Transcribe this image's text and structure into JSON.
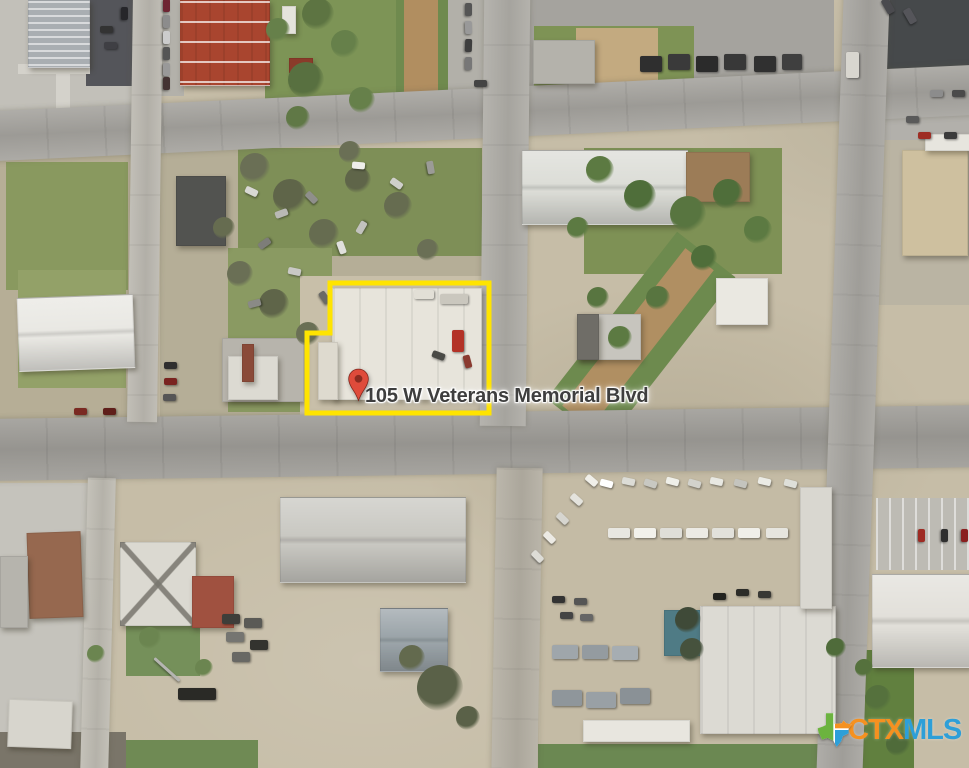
{
  "map": {
    "address_label": "105 W Veterans Memorial Blvd",
    "boundary_points": "330,283 489,283 489,413 307,413 307,333 330,333",
    "boundary_color": "#ffe400",
    "pin_color": "#df4b3b",
    "pin_hole_color": "#8c2b20",
    "label_color": "#3e3e3e"
  },
  "logo": {
    "ctx": "CTX",
    "mls": "MLS",
    "ctx_color": "#f59120",
    "mls_color": "#2d9fd8",
    "texas_green": "#6cb33f",
    "texas_orange": "#f59120",
    "texas_blue": "#2d9fd8"
  },
  "scene": {
    "ground": [
      [
        0,
        0,
        140,
        150,
        "#c2c0b9"
      ],
      [
        86,
        0,
        58,
        86,
        "#54555a"
      ],
      [
        18,
        64,
        72,
        10,
        "#d4d2cb"
      ],
      [
        56,
        64,
        14,
        50,
        "#d4d2cb"
      ],
      [
        144,
        0,
        40,
        96,
        "#b3b1aa"
      ],
      [
        265,
        0,
        132,
        124,
        "#7d9456"
      ],
      [
        396,
        0,
        52,
        122,
        "#6f8a4e"
      ],
      [
        404,
        0,
        34,
        118,
        "#b18e60"
      ],
      [
        448,
        0,
        82,
        98,
        "#b2b0a9"
      ],
      [
        528,
        0,
        306,
        96,
        "#a5a39e"
      ],
      [
        534,
        26,
        160,
        60,
        "#7e9355"
      ],
      [
        576,
        28,
        82,
        58,
        "#c3aa80"
      ],
      [
        884,
        0,
        85,
        80,
        "#46494b"
      ],
      [
        860,
        80,
        109,
        84,
        "#b2b0ab"
      ],
      [
        0,
        150,
        136,
        270,
        "#b6ae96"
      ],
      [
        6,
        162,
        122,
        128,
        "#89995f"
      ],
      [
        18,
        270,
        108,
        118,
        "#93a168"
      ],
      [
        160,
        148,
        322,
        270,
        "#b5ae97"
      ],
      [
        238,
        148,
        244,
        108,
        "#7e8f57"
      ],
      [
        228,
        248,
        104,
        164,
        "#8a9a62"
      ],
      [
        300,
        276,
        190,
        140,
        "#c8bfa9"
      ],
      [
        584,
        148,
        198,
        126,
        "#7e9155"
      ],
      [
        604,
        232,
        74,
        212,
        "#6d8a4e",
        38
      ],
      [
        620,
        238,
        36,
        200,
        "#b08f62",
        38
      ],
      [
        856,
        140,
        113,
        165,
        "#bab4a3"
      ],
      [
        540,
        462,
        286,
        316,
        "#c4bba5"
      ],
      [
        876,
        498,
        93,
        72,
        "#bdbbb4",
        0,
        "pstripes"
      ],
      [
        0,
        483,
        88,
        285,
        "#c5c3bc"
      ],
      [
        856,
        650,
        58,
        118,
        "#61803f"
      ],
      [
        126,
        614,
        74,
        62,
        "#75905a"
      ],
      [
        538,
        744,
        284,
        24,
        "#6b8852"
      ],
      [
        124,
        740,
        134,
        28,
        "#6f8a54"
      ],
      [
        0,
        732,
        126,
        36,
        "#7a7569"
      ]
    ],
    "roads": [
      [
        -12,
        88,
        994,
        50,
        "#a8a6a1",
        -2.7,
        "hroad"
      ],
      [
        -12,
        412,
        994,
        62,
        "#a19f9a",
        -0.8,
        "hroad"
      ],
      [
        482,
        -6,
        46,
        432,
        "#b0aea8",
        0.6,
        "vroad"
      ],
      [
        494,
        468,
        46,
        306,
        "#b6b1a5",
        1,
        "vroad"
      ],
      [
        830,
        -6,
        46,
        784,
        "#a9a7a2",
        2,
        "vroad"
      ],
      [
        130,
        -6,
        30,
        428,
        "#bdbab2",
        0.8,
        "vroad"
      ],
      [
        84,
        478,
        28,
        296,
        "#c0bdb4",
        1.5,
        "vroad"
      ]
    ],
    "buildings": [
      [
        28,
        0,
        60,
        66,
        "#a9aeb2",
        0,
        "stripesH"
      ],
      [
        180,
        0,
        88,
        84,
        "#a9452f",
        0,
        "redroof"
      ],
      [
        282,
        6,
        12,
        26,
        "#e5e3dc"
      ],
      [
        289,
        58,
        22,
        13,
        "#8a3b2a"
      ],
      [
        290,
        73,
        22,
        12,
        "#7e3626"
      ],
      [
        522,
        150,
        164,
        73,
        "#dcddd7",
        0,
        "ridgeH"
      ],
      [
        686,
        152,
        62,
        48,
        "#9c7c57"
      ],
      [
        716,
        278,
        50,
        45,
        "#eae8e1"
      ],
      [
        577,
        314,
        62,
        44,
        "#c7c5be"
      ],
      [
        577,
        314,
        20,
        44,
        "#6f6d67"
      ],
      [
        902,
        150,
        64,
        104,
        "#cec09f"
      ],
      [
        925,
        134,
        44,
        15,
        "#e7e5de"
      ],
      [
        176,
        176,
        48,
        68,
        "#525350"
      ],
      [
        18,
        296,
        114,
        72,
        "#e9e8e3",
        -2,
        "ridgeH"
      ],
      [
        222,
        338,
        80,
        62,
        "#b7b4ac"
      ],
      [
        228,
        356,
        48,
        42,
        "#dcdad2"
      ],
      [
        242,
        344,
        10,
        36,
        "#8a4a38"
      ],
      [
        332,
        288,
        148,
        110,
        "#e7e4db",
        0,
        "seams"
      ],
      [
        318,
        342,
        18,
        56,
        "#dedacf"
      ],
      [
        28,
        532,
        52,
        84,
        "#96684f",
        -2
      ],
      [
        120,
        542,
        74,
        82,
        "#dbd9d1",
        0,
        "xroof"
      ],
      [
        192,
        576,
        40,
        50,
        "#a05140"
      ],
      [
        280,
        497,
        184,
        84,
        "#c9c8c2",
        0,
        "ridgeH"
      ],
      [
        380,
        608,
        66,
        62,
        "#9ba4a9",
        0,
        "ridgeH"
      ],
      [
        664,
        610,
        40,
        44,
        "#4f7b85"
      ],
      [
        700,
        606,
        134,
        126,
        "#dcdad3",
        0,
        "seams"
      ],
      [
        800,
        487,
        30,
        120,
        "#d9d7d0"
      ],
      [
        872,
        574,
        96,
        92,
        "#e2e0da",
        0,
        "ridgeH"
      ],
      [
        8,
        700,
        62,
        46,
        "#d7d5cd",
        2
      ],
      [
        0,
        556,
        26,
        70,
        "#b6b4ad"
      ],
      [
        533,
        40,
        60,
        42,
        "#b4b2ab"
      ],
      [
        583,
        720,
        105,
        20,
        "#e8e6df"
      ]
    ],
    "trees": [
      [
        318,
        14,
        16,
        "#5d7442"
      ],
      [
        345,
        44,
        14,
        "#66804a"
      ],
      [
        306,
        80,
        18,
        "#587040"
      ],
      [
        362,
        100,
        13,
        "#66804a"
      ],
      [
        298,
        118,
        12,
        "#607846"
      ],
      [
        278,
        30,
        12,
        "#66804a"
      ],
      [
        255,
        168,
        15,
        "#6a6f55"
      ],
      [
        290,
        196,
        17,
        "#5f6549"
      ],
      [
        324,
        234,
        15,
        "#666c50"
      ],
      [
        240,
        274,
        13,
        "#6a6f55"
      ],
      [
        274,
        304,
        15,
        "#5f6549"
      ],
      [
        308,
        334,
        12,
        "#6a6f55"
      ],
      [
        358,
        180,
        13,
        "#5f6549"
      ],
      [
        398,
        206,
        14,
        "#666c50"
      ],
      [
        428,
        250,
        11,
        "#6a6f55"
      ],
      [
        224,
        228,
        11,
        "#666c50"
      ],
      [
        350,
        152,
        11,
        "#6a6f55"
      ],
      [
        600,
        170,
        14,
        "#5c7a42"
      ],
      [
        640,
        196,
        16,
        "#4f6e3a"
      ],
      [
        688,
        214,
        18,
        "#587540"
      ],
      [
        728,
        194,
        15,
        "#4f6e3a"
      ],
      [
        758,
        230,
        14,
        "#5c7a42"
      ],
      [
        704,
        258,
        13,
        "#4f6e3a"
      ],
      [
        658,
        298,
        12,
        "#587540"
      ],
      [
        620,
        338,
        12,
        "#5c7a42"
      ],
      [
        598,
        298,
        11,
        "#587540"
      ],
      [
        578,
        228,
        11,
        "#5c7a42"
      ],
      [
        440,
        688,
        23,
        "#5a6148"
      ],
      [
        412,
        658,
        13,
        "#636a4e"
      ],
      [
        468,
        718,
        12,
        "#5a6148"
      ],
      [
        96,
        654,
        9,
        "#6b8550"
      ],
      [
        150,
        638,
        11,
        "#6b8550"
      ],
      [
        204,
        668,
        9,
        "#6b8550"
      ],
      [
        878,
        698,
        13,
        "#55713d"
      ],
      [
        898,
        744,
        12,
        "#4f6b3a"
      ],
      [
        864,
        668,
        9,
        "#55713d"
      ],
      [
        688,
        620,
        13,
        "#3f4a38"
      ],
      [
        692,
        650,
        12,
        "#46523d"
      ],
      [
        836,
        648,
        10,
        "#4f6b3a"
      ]
    ],
    "vehicles": [
      [
        160,
        2,
        "#6e2533",
        90
      ],
      [
        160,
        18,
        "#8c8c8c",
        90
      ],
      [
        160,
        34,
        "#cccccc",
        90
      ],
      [
        160,
        50,
        "#555555",
        90
      ],
      [
        160,
        66,
        "#999999",
        90
      ],
      [
        160,
        80,
        "#443333",
        90
      ],
      [
        100,
        26,
        "#333333",
        0
      ],
      [
        118,
        10,
        "#26262a",
        90
      ],
      [
        104,
        42,
        "#3f3f44",
        0
      ],
      [
        462,
        6,
        "#555555",
        90
      ],
      [
        462,
        24,
        "#999999",
        88
      ],
      [
        462,
        42,
        "#3e3e3e",
        92
      ],
      [
        462,
        60,
        "#777777",
        90
      ],
      [
        474,
        80,
        "#444444",
        0
      ],
      [
        640,
        56,
        "#2f2f2f",
        0,
        22,
        16
      ],
      [
        668,
        54,
        "#3a3a3a",
        0,
        22,
        16
      ],
      [
        696,
        56,
        "#2b2b2b",
        0,
        22,
        16
      ],
      [
        724,
        54,
        "#383838",
        0,
        22,
        16
      ],
      [
        754,
        56,
        "#303030",
        0,
        22,
        16
      ],
      [
        782,
        54,
        "#3f3f3f",
        0,
        20,
        16
      ],
      [
        846,
        52,
        "#d8d6cf",
        0,
        13,
        26
      ],
      [
        930,
        90,
        "#8c8c8c",
        0
      ],
      [
        952,
        90,
        "#4a4a4a",
        0
      ],
      [
        906,
        116,
        "#5a5a5a",
        0
      ],
      [
        918,
        132,
        "#9e2d24",
        0
      ],
      [
        944,
        132,
        "#3b3b3b",
        0
      ],
      [
        880,
        2,
        "#4a4a4e",
        60,
        16,
        8
      ],
      [
        902,
        12,
        "#55555a",
        60,
        16,
        8
      ],
      [
        245,
        188,
        "#d8d8d4",
        25
      ],
      [
        275,
        210,
        "#b9b9b5",
        -20
      ],
      [
        305,
        194,
        "#8f8f8b",
        45
      ],
      [
        335,
        244,
        "#e0e0dc",
        70
      ],
      [
        258,
        240,
        "#7d7d79",
        -35
      ],
      [
        288,
        268,
        "#c9c9c5",
        12
      ],
      [
        318,
        294,
        "#6a6a66",
        55
      ],
      [
        352,
        162,
        "#eeeeea",
        5
      ],
      [
        390,
        180,
        "#cfcfcb",
        35
      ],
      [
        424,
        164,
        "#9b9b97",
        80
      ],
      [
        248,
        300,
        "#8a8a86",
        -15
      ],
      [
        355,
        224,
        "#c2c2be",
        -60
      ],
      [
        440,
        294,
        "#cac7be",
        0,
        28,
        10
      ],
      [
        414,
        290,
        "#e2dfd6",
        0,
        20,
        9
      ],
      [
        452,
        330,
        "#b33227",
        0,
        12,
        22
      ],
      [
        432,
        352,
        "#4a4a46",
        20
      ],
      [
        461,
        358,
        "#8a3a30",
        75
      ],
      [
        164,
        362,
        "#2f2f2f",
        0
      ],
      [
        164,
        378,
        "#7a2420",
        0
      ],
      [
        163,
        394,
        "#555555",
        0
      ],
      [
        74,
        408,
        "#7a2a22",
        0
      ],
      [
        103,
        408,
        "#5f1f1a",
        0
      ],
      [
        585,
        477,
        "#f0efe9",
        40
      ],
      [
        570,
        496,
        "#e4e3dd",
        42
      ],
      [
        556,
        515,
        "#d6d5cf",
        44
      ],
      [
        543,
        534,
        "#eceae4",
        45
      ],
      [
        531,
        553,
        "#dddcd6",
        46
      ],
      [
        600,
        480,
        "#ffffff",
        15
      ],
      [
        622,
        478,
        "#dcdcd6",
        12
      ],
      [
        644,
        480,
        "#c8c8c2",
        18
      ],
      [
        666,
        478,
        "#efefe9",
        14
      ],
      [
        688,
        480,
        "#d2d2cc",
        16
      ],
      [
        710,
        478,
        "#e8e8e2",
        12
      ],
      [
        734,
        480,
        "#c4c4be",
        15
      ],
      [
        758,
        478,
        "#ebebe5",
        13
      ],
      [
        784,
        480,
        "#dedfd9",
        14
      ],
      [
        608,
        528,
        "#e8e7e1",
        0,
        22,
        10
      ],
      [
        634,
        528,
        "#f2f1eb",
        0,
        22,
        10
      ],
      [
        660,
        528,
        "#dfded8",
        0,
        22,
        10
      ],
      [
        686,
        528,
        "#eceae4",
        0,
        22,
        10
      ],
      [
        712,
        528,
        "#e2e1db",
        0,
        22,
        10
      ],
      [
        738,
        528,
        "#f0efe9",
        0,
        22,
        10
      ],
      [
        766,
        528,
        "#e6e5df",
        0,
        22,
        10
      ],
      [
        552,
        596,
        "#333333",
        0
      ],
      [
        574,
        598,
        "#555555",
        0
      ],
      [
        560,
        612,
        "#444444",
        0
      ],
      [
        580,
        614,
        "#666666",
        0
      ],
      [
        552,
        645,
        "#9fa6ab",
        0,
        26,
        14
      ],
      [
        582,
        645,
        "#949ba0",
        0,
        26,
        14
      ],
      [
        612,
        646,
        "#a6adb2",
        0,
        26,
        14
      ],
      [
        552,
        690,
        "#8f969b",
        0,
        30,
        16
      ],
      [
        586,
        692,
        "#99a0a5",
        0,
        30,
        16
      ],
      [
        620,
        688,
        "#8a9196",
        0,
        30,
        16
      ],
      [
        736,
        589,
        "#2c2c28",
        0
      ],
      [
        758,
        591,
        "#383834",
        0
      ],
      [
        713,
        593,
        "#23231f",
        0
      ],
      [
        222,
        614,
        "#3e3e3a",
        0,
        18,
        10
      ],
      [
        244,
        618,
        "#5a5a56",
        0,
        18,
        10
      ],
      [
        226,
        632,
        "#757571",
        0,
        18,
        10
      ],
      [
        250,
        640,
        "#33332f",
        0,
        18,
        10
      ],
      [
        232,
        652,
        "#686864",
        0,
        18,
        10
      ],
      [
        178,
        688,
        "#2a2a26",
        0,
        38,
        12
      ],
      [
        150,
        668,
        "#b5b5b1",
        42,
        34,
        3
      ],
      [
        915,
        532,
        "#9e2b23",
        90
      ],
      [
        938,
        532,
        "#2f2f2f",
        90
      ],
      [
        958,
        532,
        "#8a1f1f",
        90
      ]
    ]
  }
}
